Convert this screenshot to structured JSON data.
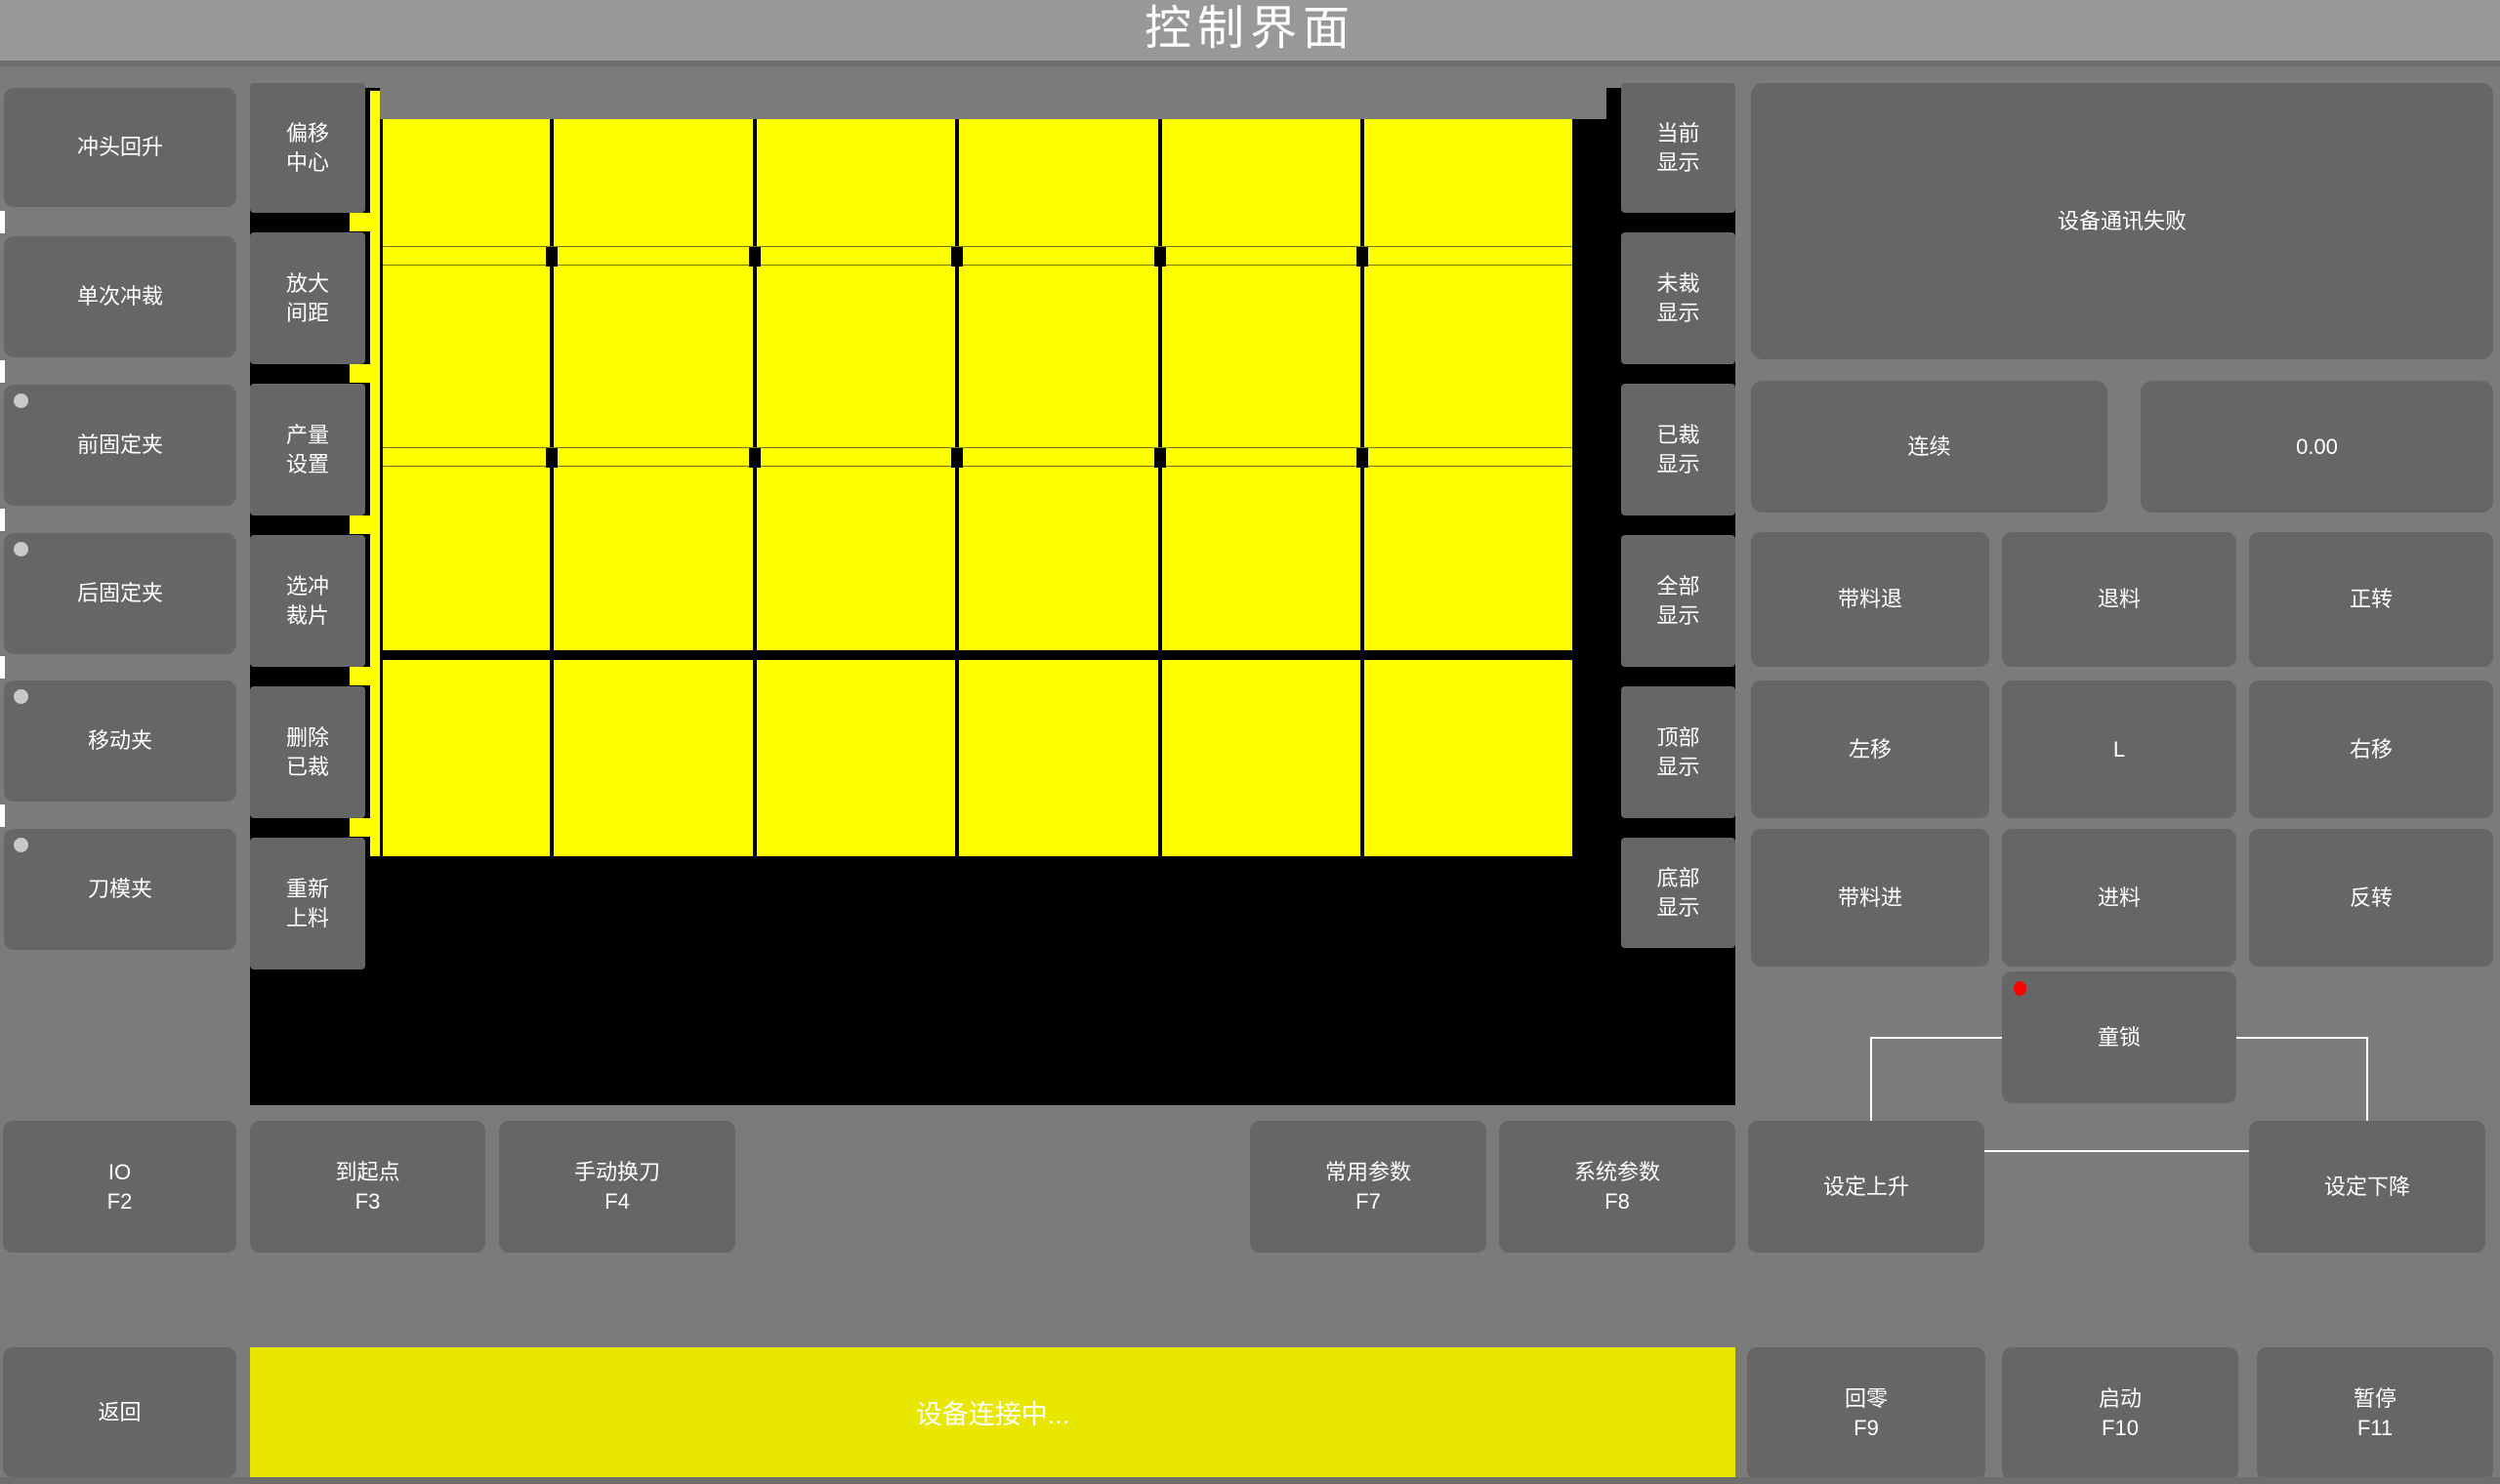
{
  "title": "控制界面",
  "left_column": {
    "items": [
      {
        "label": "冲头回升",
        "indicator": false
      },
      {
        "label": "单次冲裁",
        "indicator": false
      },
      {
        "label": "前固定夹",
        "indicator": true
      },
      {
        "label": "后固定夹",
        "indicator": true
      },
      {
        "label": "移动夹",
        "indicator": true
      },
      {
        "label": "刀模夹",
        "indicator": true
      }
    ]
  },
  "tool_column": {
    "items": [
      {
        "label": "偏移中心"
      },
      {
        "label": "放大间距"
      },
      {
        "label": "产量设置"
      },
      {
        "label": "选冲裁片"
      },
      {
        "label": "删除已裁"
      },
      {
        "label": "重新上料"
      }
    ]
  },
  "display_column": {
    "items": [
      {
        "label": "当前显示"
      },
      {
        "label": "未裁显示"
      },
      {
        "label": "已裁显示"
      },
      {
        "label": "全部显示"
      },
      {
        "label": "顶部显示"
      },
      {
        "label": "底部显示"
      }
    ]
  },
  "material_view": {
    "rows": 4,
    "cols": 6,
    "piece_color": "#ffff00",
    "background_color": "#000000"
  },
  "right_panel": {
    "status_message": "设备通讯失败",
    "mode_button": "连续",
    "value_display": "0.00",
    "jog_buttons": [
      [
        "带料退",
        "退料",
        "正转"
      ],
      [
        "左移",
        "L",
        "右移"
      ],
      [
        "带料进",
        "进料",
        "反转"
      ]
    ],
    "child_lock": "童锁"
  },
  "function_row": {
    "items": [
      {
        "label": "IO",
        "fkey": "F2"
      },
      {
        "label": "到起点",
        "fkey": "F3"
      },
      {
        "label": "手动换刀",
        "fkey": "F4"
      },
      {
        "label": "常用参数",
        "fkey": "F7"
      },
      {
        "label": "系统参数",
        "fkey": "F8"
      },
      {
        "label": "设定上升",
        "fkey": ""
      },
      {
        "label": "设定下降",
        "fkey": ""
      }
    ]
  },
  "bottom_bar": {
    "back_label": "返回",
    "status_text": "设备连接中...",
    "buttons": [
      {
        "label": "回零",
        "fkey": "F9"
      },
      {
        "label": "启动",
        "fkey": "F10"
      },
      {
        "label": "暂停",
        "fkey": "F11"
      }
    ]
  },
  "colors": {
    "page_background": "#7b7b7b",
    "titlebar": "#989898",
    "button": "#666666",
    "material_yellow": "#ffff00",
    "statusbar_yellow": "#e9e600",
    "alert_red": "#ff0000",
    "indicator_gray": "#c9c9c9"
  }
}
